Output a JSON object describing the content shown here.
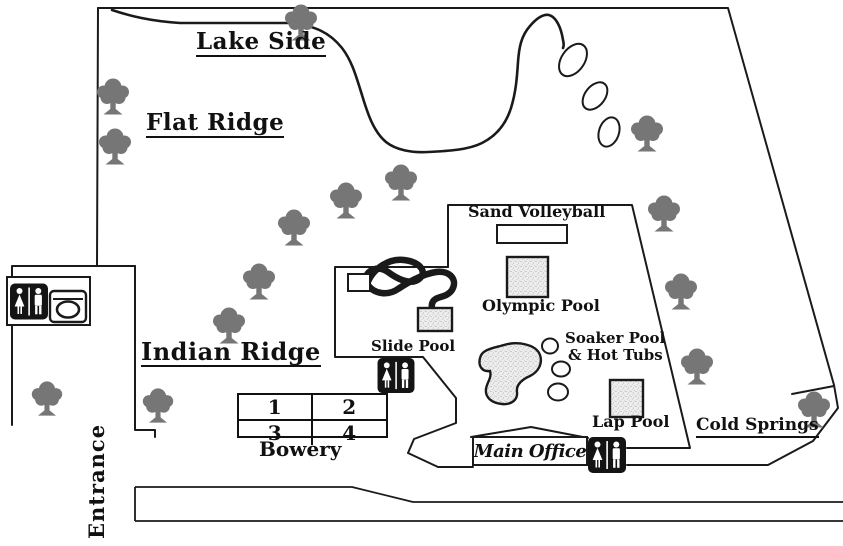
{
  "labels": {
    "lake_side": "Lake Side",
    "flat_ridge": "Flat Ridge",
    "indian_ridge": "Indian Ridge",
    "cold_springs": "Cold Springs",
    "bowery": "Bowery",
    "entrance": "Entrance",
    "sand_volleyball": "Sand Volleyball",
    "olympic_pool": "Olympic Pool",
    "slide_pool": "Slide Pool",
    "soaker_pool": "Soaker Pool",
    "hot_tubs": "& Hot Tubs",
    "lap_pool": "Lap Pool",
    "main_office": "Main Office"
  },
  "bowery_sites": [
    "1",
    "2",
    "3",
    "4"
  ],
  "icons": {
    "restroom": "restroom-sign",
    "laundry": "washing-machine",
    "tree": "oak-tree"
  },
  "colors": {
    "outline": "#1a1a1a",
    "tree": "#767676",
    "sign": "#141414",
    "pool-base": "#ededed"
  }
}
